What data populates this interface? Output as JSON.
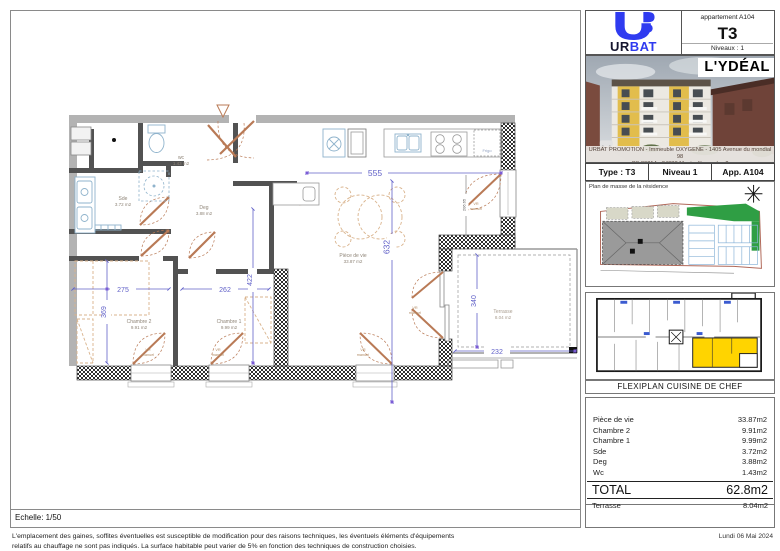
{
  "brand": {
    "prefix": "UR",
    "suffix": "BAT"
  },
  "apartment_box": {
    "label": "appartement A104",
    "type": "T3",
    "levels": "Niveaux : 1"
  },
  "project": {
    "title": "L'YDÉAL",
    "address_line1": "URBAT PROMOTION - Immeuble OXYGENE - 1405 Avenue du mondial 98",
    "address_line2": "CS 89214 - 34088 Montpellier cedex 2"
  },
  "summary": {
    "type": "Type : T3",
    "level": "Niveau 1",
    "app": "App. A104"
  },
  "site_plan": {
    "caption": "Plan de masse de la résidence"
  },
  "flexiplan": {
    "caption": "FLEXIPLAN CUISINE DE CHEF"
  },
  "areas": {
    "rows": [
      {
        "label": "Pièce de vie",
        "value": "33.87m2"
      },
      {
        "label": "Chambre 2",
        "value": "9.91m2"
      },
      {
        "label": "Chambre 1",
        "value": "9.99m2"
      },
      {
        "label": "Sde",
        "value": "3.72m2"
      },
      {
        "label": "Deg",
        "value": "3.88m2"
      },
      {
        "label": "Wc",
        "value": "1.43m2"
      }
    ],
    "total_label": "TOTAL",
    "total_value": "62.8m2",
    "terrace_label": "Terrasse",
    "terrace_value": "8.04m2"
  },
  "footer": {
    "scale": "Echelle: 1/50",
    "date": "Lundi 06 Mai 2024",
    "disclaimer_line1": "L'emplacement des gaines, soffites éventuelles est susceptible de modification pour des raisons techniques, les éventuels éléments d'équipements",
    "disclaimer_line2": "relatifs au chauffage ne sont pas indiqués. La surface habitable peut varier de 5% en fonction des techniques de construction choisies."
  },
  "plan": {
    "rooms": {
      "wc": {
        "name": "wc",
        "area": "1.43 m2"
      },
      "sde": {
        "name": "Sde",
        "area": "3.72 m2"
      },
      "deg": {
        "name": "Deg",
        "area": "3.88 m2"
      },
      "living": {
        "name": "Pièce de vie",
        "area": "33.87 m2"
      },
      "ch2": {
        "name": "Chambre 2",
        "area": "9.91 m2"
      },
      "ch1": {
        "name": "Chambre 1",
        "area": "9.99 m2"
      },
      "terrace": {
        "name": "Terrasse",
        "area": "8.04 m2"
      }
    },
    "dims": {
      "d555": "555",
      "d632": "632",
      "d275": "275",
      "d369": "369",
      "d262": "262",
      "d422": "422",
      "d340": "340",
      "d232": "232",
      "dwin": "206.65"
    },
    "labels": {
      "vr_line1": "VR",
      "vr_line2": "manuel",
      "fridge": "Frigo"
    }
  },
  "colors": {
    "brand_blue": "#2f3bf0",
    "dimension_blue": "#6161c8",
    "door_orange": "#b97a56",
    "fixture_blue": "#8fb3cc",
    "highlight_yellow": "#ffd400"
  }
}
